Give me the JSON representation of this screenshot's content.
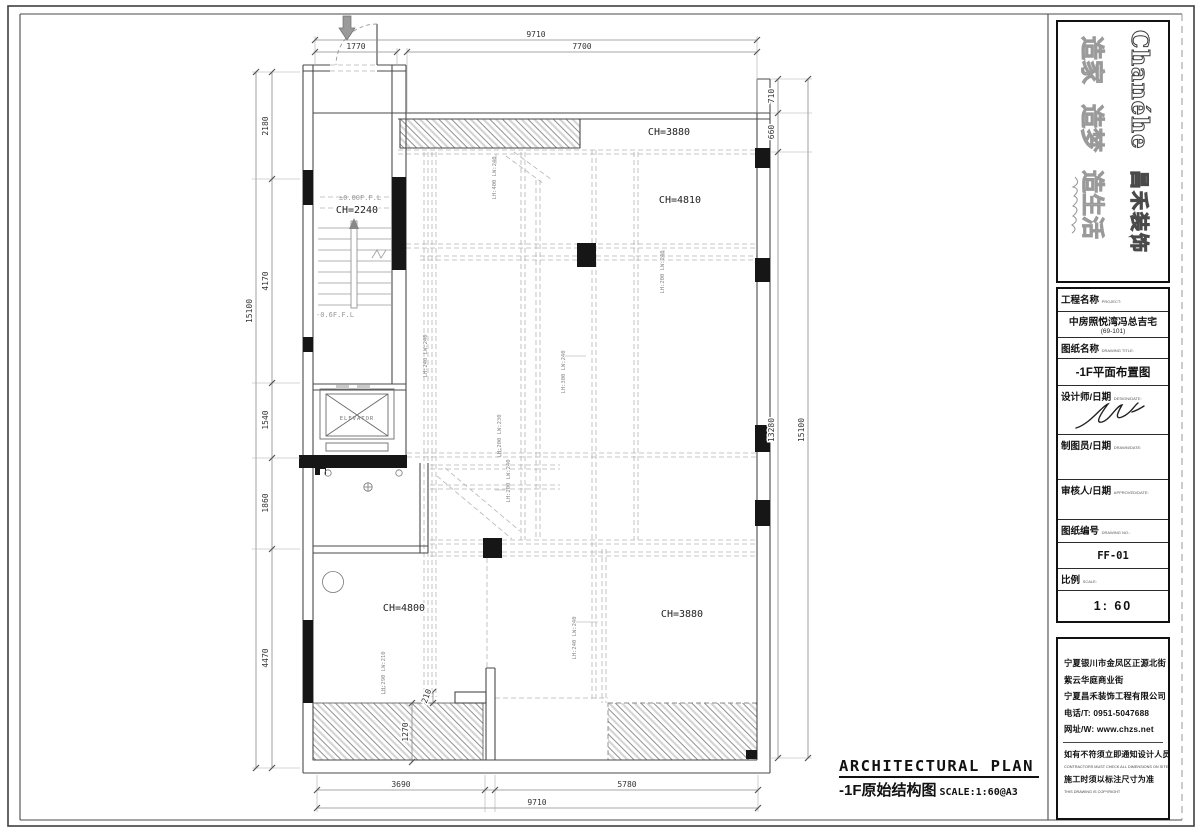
{
  "logo": {
    "brand": "Chanéhe",
    "brand_cn": "昌禾装饰",
    "slogan_1": "造家",
    "slogan_2": "造梦",
    "slogan_3": "造生活"
  },
  "titleblock": {
    "project_label": "工程名称",
    "project_label_en": "PROJECT:",
    "project_name": "中房照悦湾冯总吉宅",
    "project_no": "(69-101)",
    "drawing_label": "图纸名称",
    "drawing_label_en": "DRAWING TITLE:",
    "drawing_name": "-1F平面布置图",
    "designer_label": "设计师/日期",
    "designer_label_en": "DESIGN/DATE:",
    "drafter_label": "制图员/日期",
    "drafter_label_en": "DRAWN/DATE:",
    "approver_label": "审核人/日期",
    "approver_label_en": "APPROVED/DATE:",
    "number_label": "图纸编号",
    "number_label_en": "DRAWING NO.:",
    "number_value": "FF-01",
    "scale_label": "比例",
    "scale_label_en": "SCALE:",
    "scale_value": "1: 60"
  },
  "company": {
    "address1": "宁夏银川市金凤区正源北街",
    "address2": "紫云华庭商业街",
    "name": "宁夏昌禾装饰工程有限公司",
    "phone": "电话/T: 0951-5047688",
    "web": "网址/W: www.chzs.net",
    "note1_cn": "如有不符须立即通知设计人员",
    "note1_en": "CONTRACTORS MUST CHECK ALL DIMENSIONS ON SITE",
    "note2_cn": "施工时须以标注尺寸为准",
    "note2_en": "THIS DRAWING IS COPYRIGHT"
  },
  "footer": {
    "title_en": "ARCHITECTURAL PLAN",
    "title_cn": "-1F原始结构图",
    "scale": "SCALE:1:60@A3"
  },
  "plan": {
    "rooms": {
      "entry_level": "±0.00F.F.L",
      "entry_ch": "CH=2240",
      "lower_level": "-0.6F.F.L",
      "elevator": "ELEVATOR",
      "top_strip_ch": "CH=3880",
      "main_ch": "CH=4810",
      "left_room_ch": "CH=4800",
      "right_room_ch": "CH=3880"
    },
    "dims": {
      "top_overall": "9710",
      "top_left": "1770",
      "top_right": "7700",
      "left": [
        "2180",
        "4170",
        "1540",
        "1860",
        "4470"
      ],
      "left_overall": "15100",
      "right": [
        "710",
        "660",
        "13280"
      ],
      "right_overall": "15100",
      "bottom": [
        "3690",
        "5780"
      ],
      "bottom_overall": "9710",
      "hatch_width": "1270",
      "step": "210"
    },
    "beams": [
      "LH:400 LW:240",
      "LH:200 LW:240",
      "LH:300 LW:240",
      "LH:200 LW:230",
      "LH:200 LW:240",
      "LH:240 LW:240",
      "LH:240 LW:240",
      "LH:290 LW:210"
    ]
  }
}
